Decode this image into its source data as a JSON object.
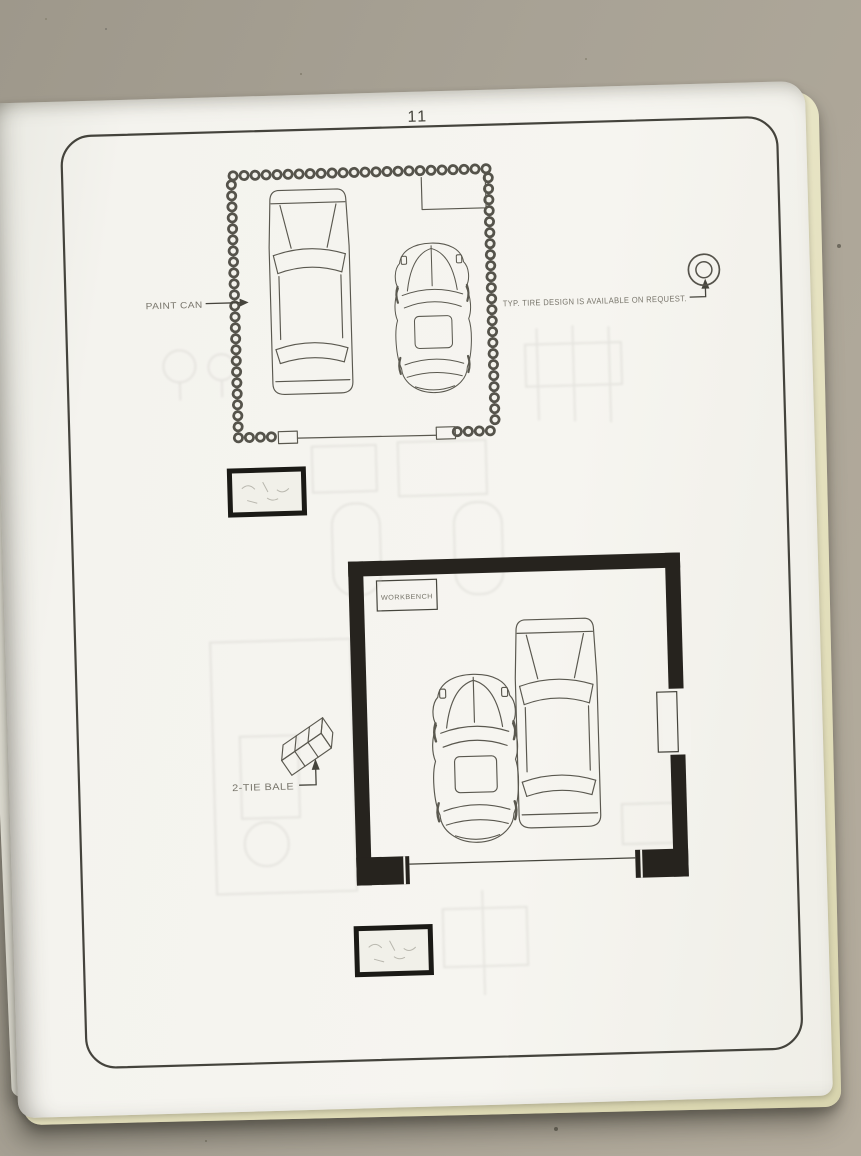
{
  "page": {
    "number": "11"
  },
  "upper_plan": {
    "callouts": {
      "paint_can": "PAINT CAN",
      "tire_note": "TYP. TIRE DESIGN IS AVAILABLE ON REQUEST."
    },
    "icons": {
      "wall": "paint-can-ring-wall",
      "tire": "tire-top-view"
    }
  },
  "lower_plan": {
    "labels": {
      "workbench": "WORKBENCH"
    },
    "callouts": {
      "bale": "2-TIE BALE"
    },
    "icons": {
      "bale": "straw-bale-3d",
      "walls": "solid-masonry-wall"
    }
  },
  "colors": {
    "table": "#a9a396",
    "page": "#f4f3ee",
    "page_edge": "#e7e3c6",
    "ink": "#45443c",
    "pencil": "#5a584f",
    "label": "#77746a",
    "wall_solid": "#26231e"
  }
}
